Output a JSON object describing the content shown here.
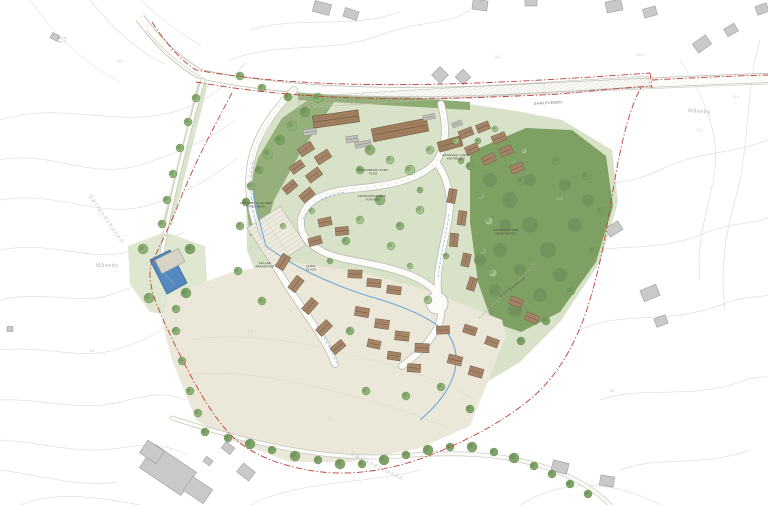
{
  "map": {
    "colors": {
      "boundary_red": "#bf4038",
      "water_blue": "#5588c0",
      "lawn_green": "#d7e2c8",
      "forest_green": "#7fa063",
      "field_beige": "#ebe8da",
      "roof_brown": "#a9886a",
      "existing_grey": "#c9c9c9"
    },
    "place_labels": [
      {
        "text": "Måseby",
        "x": 688,
        "y": 112,
        "rot": 4,
        "cls": "place"
      },
      {
        "text": "Måseby",
        "x": 96,
        "y": 267,
        "rot": 0,
        "cls": "place"
      },
      {
        "text": "Sørlandsbanen",
        "x": 88,
        "y": 196,
        "rot": 55,
        "cls": "place-it"
      },
      {
        "text": "Sørlandsbanen",
        "x": 350,
        "y": 455,
        "rot": 26,
        "cls": "place-it"
      },
      {
        "text": "GAMLEVEGEN",
        "x": 548,
        "y": 104,
        "rot": -3,
        "cls": "road-name"
      }
    ],
    "annotations": [
      {
        "x": 256,
        "y": 204,
        "rot": 0,
        "cls": "ann",
        "lines": [
          "FORDRØYNING MED",
          "OPEN BEKK"
        ]
      },
      {
        "x": 373,
        "y": 171,
        "rot": 0,
        "cls": "ann",
        "lines": [
          "OPPARBEIDD PARK",
          "PLEN"
        ]
      },
      {
        "x": 372,
        "y": 197,
        "rot": 0,
        "cls": "ann",
        "lines": [
          "GRØNTDRAG MED",
          "TURVEG"
        ]
      },
      {
        "x": 265,
        "y": 264,
        "rot": 0,
        "cls": "ann",
        "lines": [
          "FELLES",
          "PARKERING"
        ]
      },
      {
        "x": 311,
        "y": 267,
        "rot": 0,
        "cls": "ann",
        "lines": [
          "LEIKE-",
          "PLASS"
        ]
      },
      {
        "x": 506,
        "y": 231,
        "rot": 0,
        "cls": "ann",
        "lines": [
          "EKSISTERANDE",
          "VEGETASJON"
        ]
      },
      {
        "x": 513,
        "y": 288,
        "rot": -38,
        "cls": "ann",
        "lines": [
          "EKSISTERANDE STI"
        ]
      },
      {
        "x": 456,
        "y": 156,
        "rot": 0,
        "cls": "ann",
        "lines": [
          "GANGVEG LANGS",
          "KØYREVEG"
        ]
      },
      {
        "x": 62,
        "y": 39,
        "rot": 0,
        "cls": "ann-faint",
        "lines": [
          "gnr. 57",
          "bnr. 1"
        ]
      }
    ],
    "elevation_marks": [
      {
        "text": "11.2",
        "x": 498,
        "y": 58
      },
      {
        "text": "10.9",
        "x": 640,
        "y": 56
      },
      {
        "text": "11.4",
        "x": 736,
        "y": 98
      },
      {
        "text": "11.7",
        "x": 700,
        "y": 131
      },
      {
        "text": "10.2",
        "x": 560,
        "y": 200
      },
      {
        "text": "9.8",
        "x": 612,
        "y": 392
      },
      {
        "text": "4.5",
        "x": 120,
        "y": 62
      },
      {
        "text": "5.6",
        "x": 92,
        "y": 352
      },
      {
        "text": "7.2",
        "x": 330,
        "y": 420
      },
      {
        "text": "6.1",
        "x": 250,
        "y": 332
      }
    ],
    "site": {
      "houses": [
        [
          306,
          149,
          15,
          9,
          -32
        ],
        [
          323,
          157,
          15,
          9,
          -32
        ],
        [
          297,
          167,
          14,
          8,
          -36
        ],
        [
          314,
          175,
          15,
          9,
          -36
        ],
        [
          290,
          187,
          14,
          8,
          -40
        ],
        [
          307,
          195,
          14,
          9,
          -40
        ],
        [
          283,
          262,
          15,
          9,
          -58
        ],
        [
          296,
          284,
          15,
          9,
          -52
        ],
        [
          310,
          306,
          15,
          9,
          -48
        ],
        [
          324,
          328,
          15,
          9,
          -44
        ],
        [
          338,
          347,
          14,
          8,
          -40
        ],
        [
          325,
          222,
          13,
          8,
          -12
        ],
        [
          342,
          231,
          13,
          8,
          -6
        ],
        [
          315,
          241,
          13,
          8,
          -16
        ],
        [
          355,
          274,
          14,
          8,
          2
        ],
        [
          374,
          283,
          14,
          8,
          6
        ],
        [
          394,
          290,
          14,
          8,
          8
        ],
        [
          362,
          312,
          14,
          9,
          10
        ],
        [
          382,
          324,
          14,
          9,
          8
        ],
        [
          402,
          336,
          14,
          9,
          6
        ],
        [
          422,
          348,
          14,
          9,
          2
        ],
        [
          374,
          344,
          13,
          8,
          12
        ],
        [
          394,
          356,
          13,
          8,
          8
        ],
        [
          414,
          368,
          13,
          8,
          4
        ],
        [
          443,
          330,
          13,
          8,
          -2
        ],
        [
          455,
          360,
          14,
          9,
          14
        ],
        [
          476,
          372,
          14,
          9,
          16
        ],
        [
          470,
          330,
          13,
          8,
          18
        ],
        [
          492,
          342,
          13,
          8,
          20
        ],
        [
          452,
          196,
          14,
          8,
          -80
        ],
        [
          462,
          218,
          14,
          8,
          -82
        ],
        [
          454,
          240,
          13,
          8,
          -84
        ],
        [
          466,
          260,
          13,
          8,
          -78
        ],
        [
          472,
          284,
          13,
          8,
          -72
        ],
        [
          466,
          133,
          14,
          8,
          -22
        ],
        [
          483,
          127,
          13,
          8,
          -22
        ],
        [
          499,
          138,
          14,
          8,
          -22
        ],
        [
          472,
          149,
          13,
          8,
          -24
        ],
        [
          489,
          159,
          13,
          8,
          -24
        ],
        [
          506,
          151,
          13,
          8,
          -22
        ],
        [
          517,
          168,
          13,
          8,
          -20
        ],
        [
          516,
          302,
          13,
          8,
          22
        ],
        [
          532,
          318,
          13,
          8,
          24
        ]
      ],
      "terraces": [
        [
          336,
          119,
          46,
          12,
          -8
        ],
        [
          400,
          130,
          56,
          13,
          -11
        ],
        [
          450,
          144,
          24,
          10,
          -16
        ]
      ],
      "carports": [
        [
          310,
          132,
          13,
          6,
          -8
        ],
        [
          363,
          144,
          16,
          6,
          -10
        ],
        [
          429,
          117,
          12,
          5,
          -12
        ],
        [
          352,
          139,
          12,
          6,
          -9
        ],
        [
          457,
          124,
          10,
          5,
          -20
        ]
      ],
      "existing_buildings": [
        [
          322,
          8,
          17,
          11,
          15
        ],
        [
          351,
          14,
          14,
          9,
          18
        ],
        [
          440,
          75,
          12,
          12,
          45
        ],
        [
          463,
          77,
          11,
          11,
          45
        ],
        [
          480,
          5,
          15,
          10,
          8
        ],
        [
          531,
          2,
          12,
          8,
          0
        ],
        [
          614,
          6,
          16,
          11,
          -12
        ],
        [
          650,
          12,
          13,
          9,
          -15
        ],
        [
          702,
          44,
          16,
          11,
          -35
        ],
        [
          731,
          30,
          12,
          9,
          -30
        ],
        [
          762,
          9,
          12,
          9,
          -20
        ],
        [
          614,
          229,
          15,
          10,
          -32
        ],
        [
          650,
          293,
          17,
          12,
          -22
        ],
        [
          661,
          321,
          12,
          9,
          -22
        ],
        [
          560,
          467,
          16,
          11,
          14
        ],
        [
          607,
          481,
          14,
          10,
          10
        ],
        [
          55,
          37,
          8,
          6,
          28
        ],
        [
          10,
          329,
          6,
          5,
          0
        ],
        [
          228,
          448,
          11,
          8,
          38
        ],
        [
          208,
          461,
          8,
          6,
          38
        ],
        [
          246,
          472,
          15,
          11,
          38
        ],
        [
          168,
          470,
          50,
          28,
          34
        ],
        [
          152,
          452,
          20,
          15,
          34
        ],
        [
          198,
          490,
          24,
          17,
          34
        ]
      ],
      "pond_building": [
        170,
        261,
        26,
        15,
        -27
      ],
      "parking": {
        "x": 247,
        "y": 228,
        "rot": -33,
        "w": 40,
        "h": 46,
        "rows": 11
      },
      "trees": [
        [
          318,
          98,
          5,
          1
        ],
        [
          305,
          112,
          5,
          2
        ],
        [
          292,
          126,
          5,
          1
        ],
        [
          280,
          140,
          5,
          2
        ],
        [
          268,
          154,
          5,
          1
        ],
        [
          259,
          170,
          4,
          2
        ],
        [
          251,
          186,
          4,
          1
        ],
        [
          246,
          202,
          4,
          2
        ],
        [
          240,
          76,
          4,
          1
        ],
        [
          262,
          88,
          4,
          1
        ],
        [
          288,
          97,
          4,
          2
        ],
        [
          196,
          98,
          4,
          1
        ],
        [
          188,
          122,
          4,
          1
        ],
        [
          180,
          148,
          4,
          1
        ],
        [
          173,
          174,
          4,
          1
        ],
        [
          167,
          200,
          4,
          1
        ],
        [
          162,
          224,
          4,
          1
        ],
        [
          143,
          249,
          5,
          1
        ],
        [
          190,
          249,
          5,
          2
        ],
        [
          149,
          298,
          5,
          1
        ],
        [
          186,
          293,
          5,
          2
        ],
        [
          176,
          309,
          4,
          1
        ],
        [
          370,
          150,
          5,
          1
        ],
        [
          390,
          160,
          4,
          0
        ],
        [
          360,
          170,
          4,
          1
        ],
        [
          410,
          170,
          5,
          0
        ],
        [
          380,
          200,
          5,
          1
        ],
        [
          360,
          220,
          4,
          0
        ],
        [
          400,
          226,
          4,
          1
        ],
        [
          420,
          210,
          4,
          0
        ],
        [
          346,
          241,
          4,
          1
        ],
        [
          391,
          246,
          4,
          0
        ],
        [
          430,
          150,
          4,
          0
        ],
        [
          420,
          190,
          3,
          1
        ],
        [
          312,
          211,
          3,
          0
        ],
        [
          330,
          261,
          3,
          1
        ],
        [
          410,
          266,
          3,
          0
        ],
        [
          446,
          256,
          3,
          1
        ],
        [
          428,
          300,
          4,
          0
        ],
        [
          350,
          331,
          4,
          1
        ],
        [
          366,
          391,
          4,
          1
        ],
        [
          406,
          396,
          4,
          1
        ],
        [
          441,
          387,
          4,
          1
        ],
        [
          470,
          409,
          4,
          2
        ],
        [
          456,
          141,
          3,
          0
        ],
        [
          478,
          141,
          3,
          1
        ],
        [
          495,
          129,
          3,
          0
        ],
        [
          513,
          161,
          3,
          1
        ],
        [
          524,
          151,
          3,
          0
        ],
        [
          461,
          161,
          3,
          1
        ],
        [
          481,
          196,
          4,
          1
        ],
        [
          489,
          221,
          4,
          0
        ],
        [
          483,
          251,
          4,
          1
        ],
        [
          493,
          273,
          4,
          0
        ],
        [
          470,
          166,
          4,
          2
        ],
        [
          521,
          181,
          4,
          2
        ],
        [
          556,
          161,
          4,
          2
        ],
        [
          586,
          176,
          4,
          2
        ],
        [
          601,
          211,
          4,
          2
        ],
        [
          593,
          251,
          4,
          2
        ],
        [
          571,
          291,
          4,
          2
        ],
        [
          546,
          321,
          4,
          2
        ],
        [
          521,
          341,
          4,
          2
        ],
        [
          205,
          432,
          4,
          2
        ],
        [
          228,
          438,
          4,
          2
        ],
        [
          250,
          444,
          5,
          2
        ],
        [
          272,
          450,
          4,
          2
        ],
        [
          295,
          456,
          5,
          2
        ],
        [
          318,
          460,
          4,
          2
        ],
        [
          340,
          464,
          5,
          2
        ],
        [
          362,
          464,
          4,
          2
        ],
        [
          384,
          460,
          5,
          2
        ],
        [
          406,
          455,
          4,
          2
        ],
        [
          428,
          450,
          5,
          2
        ],
        [
          450,
          447,
          4,
          2
        ],
        [
          472,
          447,
          5,
          2
        ],
        [
          494,
          452,
          4,
          2
        ],
        [
          514,
          458,
          5,
          2
        ],
        [
          534,
          466,
          4,
          2
        ],
        [
          552,
          474,
          4,
          2
        ],
        [
          570,
          484,
          4,
          2
        ],
        [
          588,
          494,
          4,
          2
        ],
        [
          176,
          331,
          4,
          1
        ],
        [
          182,
          361,
          4,
          1
        ],
        [
          190,
          391,
          4,
          1
        ],
        [
          198,
          413,
          4,
          1
        ],
        [
          240,
          226,
          4,
          1
        ],
        [
          238,
          271,
          4,
          1
        ],
        [
          262,
          301,
          4,
          1
        ],
        [
          283,
          226,
          3,
          0
        ]
      ],
      "forest_blobs": [
        [
          490,
          180,
          7
        ],
        [
          510,
          200,
          8
        ],
        [
          530,
          225,
          8
        ],
        [
          548,
          250,
          8
        ],
        [
          560,
          275,
          7
        ],
        [
          540,
          295,
          7
        ],
        [
          515,
          310,
          7
        ],
        [
          495,
          290,
          6
        ],
        [
          500,
          250,
          7
        ],
        [
          520,
          270,
          6
        ],
        [
          575,
          225,
          7
        ],
        [
          588,
          200,
          6
        ],
        [
          565,
          185,
          6
        ],
        [
          505,
          225,
          6
        ],
        [
          480,
          260,
          6
        ],
        [
          530,
          180,
          6
        ]
      ]
    }
  }
}
